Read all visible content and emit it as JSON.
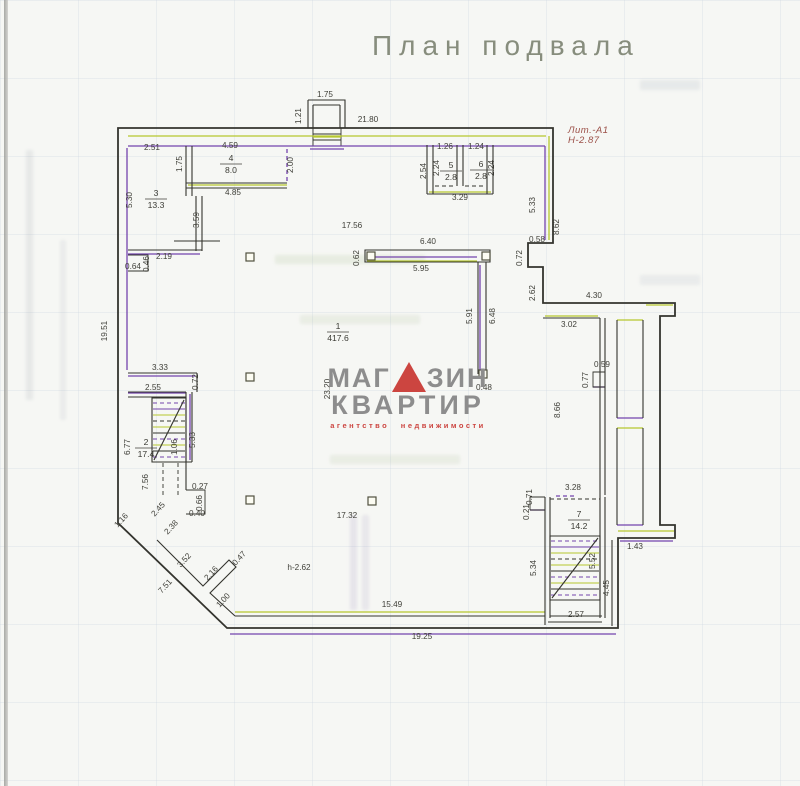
{
  "page": {
    "title": "План подвала",
    "litera": {
      "line1": "Лит.-А1",
      "line2": "Н-2.87"
    }
  },
  "watermark": {
    "word1_left": "МАГ",
    "word1_right": "ЗИН",
    "word2": "КВАРТИР",
    "tagline": "агентство недвижимости",
    "accent_color": "#cc4540",
    "text_color": "#8d8d8d"
  },
  "plan": {
    "colors": {
      "wall": "#34342e",
      "accent_purple": "#7444ad",
      "accent_green": "#b6c72e",
      "dim_text": "#3f3f38"
    },
    "rooms": [
      {
        "num": "1",
        "area": "417.6",
        "x": 338,
        "y": 331
      },
      {
        "num": "2",
        "area": "17.4",
        "x": 146,
        "y": 447
      },
      {
        "num": "3",
        "area": "13.3",
        "x": 156,
        "y": 198
      },
      {
        "num": "4",
        "area": "8.0",
        "x": 231,
        "y": 163
      },
      {
        "num": "5",
        "area": "2.8",
        "x": 451,
        "y": 170
      },
      {
        "num": "6",
        "area": "2.8",
        "x": 481,
        "y": 169
      },
      {
        "num": "7",
        "area": "14.2",
        "x": 579,
        "y": 519
      }
    ],
    "columns": [
      {
        "x": 250,
        "y": 257
      },
      {
        "x": 250,
        "y": 377
      },
      {
        "x": 250,
        "y": 500
      },
      {
        "x": 372,
        "y": 501
      },
      {
        "x": 371,
        "y": 256
      },
      {
        "x": 486,
        "y": 256
      },
      {
        "x": 483,
        "y": 374
      }
    ],
    "dimensions": [
      {
        "t": "1.75",
        "x": 325,
        "y": 97,
        "r": 0
      },
      {
        "t": "1.21",
        "x": 301,
        "y": 116,
        "r": -90
      },
      {
        "t": "21.80",
        "x": 368,
        "y": 122,
        "r": 0
      },
      {
        "t": "2.51",
        "x": 152,
        "y": 150,
        "r": 0
      },
      {
        "t": "4.59",
        "x": 230,
        "y": 148,
        "r": 0
      },
      {
        "t": "1.75",
        "x": 182,
        "y": 164,
        "r": -90
      },
      {
        "t": "2.00",
        "x": 293,
        "y": 165,
        "r": -90
      },
      {
        "t": "4.85",
        "x": 233,
        "y": 195,
        "r": 0
      },
      {
        "t": "5.30",
        "x": 132,
        "y": 200,
        "r": -90
      },
      {
        "t": "3.59",
        "x": 199,
        "y": 220,
        "r": -90
      },
      {
        "t": "1.26",
        "x": 445,
        "y": 149,
        "r": 0
      },
      {
        "t": "1.24",
        "x": 476,
        "y": 149,
        "r": 0
      },
      {
        "t": "2.54",
        "x": 426,
        "y": 171,
        "r": -90
      },
      {
        "t": "2.24",
        "x": 439,
        "y": 168,
        "r": -90
      },
      {
        "t": "2.24",
        "x": 494,
        "y": 168,
        "r": -90
      },
      {
        "t": "3.29",
        "x": 460,
        "y": 200,
        "r": 0
      },
      {
        "t": "5.33",
        "x": 535,
        "y": 205,
        "r": -90
      },
      {
        "t": "8.62",
        "x": 559,
        "y": 227,
        "r": -90
      },
      {
        "t": "17.56",
        "x": 352,
        "y": 228,
        "r": 0
      },
      {
        "t": "2.19",
        "x": 164,
        "y": 259,
        "r": 0
      },
      {
        "t": "0.64",
        "x": 133,
        "y": 269,
        "r": 0
      },
      {
        "t": "0.46",
        "x": 149,
        "y": 264,
        "r": -90
      },
      {
        "t": "6.40",
        "x": 428,
        "y": 244,
        "r": 0
      },
      {
        "t": "0.62",
        "x": 359,
        "y": 258,
        "r": -90
      },
      {
        "t": "5.95",
        "x": 421,
        "y": 271,
        "r": 0
      },
      {
        "t": "5.91",
        "x": 472,
        "y": 316,
        "r": -90
      },
      {
        "t": "6.48",
        "x": 495,
        "y": 316,
        "r": -90
      },
      {
        "t": "0.48",
        "x": 484,
        "y": 390,
        "r": 0
      },
      {
        "t": "0.58",
        "x": 537,
        "y": 242,
        "r": 0
      },
      {
        "t": "0.72",
        "x": 522,
        "y": 258,
        "r": -90
      },
      {
        "t": "2.62",
        "x": 535,
        "y": 293,
        "r": -90
      },
      {
        "t": "4.30",
        "x": 594,
        "y": 298,
        "r": 0
      },
      {
        "t": "3.02",
        "x": 569,
        "y": 327,
        "r": 0
      },
      {
        "t": "19.51",
        "x": 107,
        "y": 331,
        "r": -90
      },
      {
        "t": "23.20",
        "x": 330,
        "y": 389,
        "r": -90
      },
      {
        "t": "3.33",
        "x": 160,
        "y": 370,
        "r": 0
      },
      {
        "t": "0.72",
        "x": 198,
        "y": 382,
        "r": -90
      },
      {
        "t": "2.55",
        "x": 153,
        "y": 390,
        "r": 0
      },
      {
        "t": "0.59",
        "x": 602,
        "y": 367,
        "r": 0
      },
      {
        "t": "0.77",
        "x": 588,
        "y": 380,
        "r": -90
      },
      {
        "t": "8.66",
        "x": 560,
        "y": 410,
        "r": -90
      },
      {
        "t": "5.33",
        "x": 195,
        "y": 440,
        "r": -90
      },
      {
        "t": "6.77",
        "x": 130,
        "y": 447,
        "r": -90
      },
      {
        "t": "1.06",
        "x": 177,
        "y": 447,
        "r": -90
      },
      {
        "t": "7.56",
        "x": 148,
        "y": 482,
        "r": -90
      },
      {
        "t": "3.28",
        "x": 573,
        "y": 490,
        "r": 0
      },
      {
        "t": "0.71",
        "x": 532,
        "y": 497,
        "r": -90
      },
      {
        "t": "0.21",
        "x": 529,
        "y": 512,
        "r": -90
      },
      {
        "t": "5.34",
        "x": 536,
        "y": 568,
        "r": -90
      },
      {
        "t": "5.52",
        "x": 595,
        "y": 561,
        "r": -90
      },
      {
        "t": "1.43",
        "x": 635,
        "y": 549,
        "r": 0
      },
      {
        "t": "4.45",
        "x": 609,
        "y": 588,
        "r": -90
      },
      {
        "t": "2.57",
        "x": 576,
        "y": 617,
        "r": 0
      },
      {
        "t": "0.27",
        "x": 200,
        "y": 489,
        "r": 0
      },
      {
        "t": "0.66",
        "x": 202,
        "y": 503,
        "r": -90
      },
      {
        "t": "0.40",
        "x": 197,
        "y": 516,
        "r": 0
      },
      {
        "t": "1.16",
        "x": 123,
        "y": 522,
        "r": -47
      },
      {
        "t": "2.45",
        "x": 160,
        "y": 511,
        "r": -47
      },
      {
        "t": "2.38",
        "x": 173,
        "y": 529,
        "r": -47
      },
      {
        "t": "3.52",
        "x": 186,
        "y": 562,
        "r": -47
      },
      {
        "t": "2.16",
        "x": 213,
        "y": 575,
        "r": -47
      },
      {
        "t": "0.47",
        "x": 241,
        "y": 560,
        "r": -47
      },
      {
        "t": "1.00",
        "x": 225,
        "y": 602,
        "r": -47
      },
      {
        "t": "7.51",
        "x": 167,
        "y": 588,
        "r": -47
      },
      {
        "t": "17.32",
        "x": 347,
        "y": 518,
        "r": 0
      },
      {
        "t": "h-2.62",
        "x": 299,
        "y": 570,
        "r": 0
      },
      {
        "t": "15.49",
        "x": 392,
        "y": 607,
        "r": 0
      },
      {
        "t": "19.25",
        "x": 422,
        "y": 639,
        "r": 0
      }
    ]
  }
}
